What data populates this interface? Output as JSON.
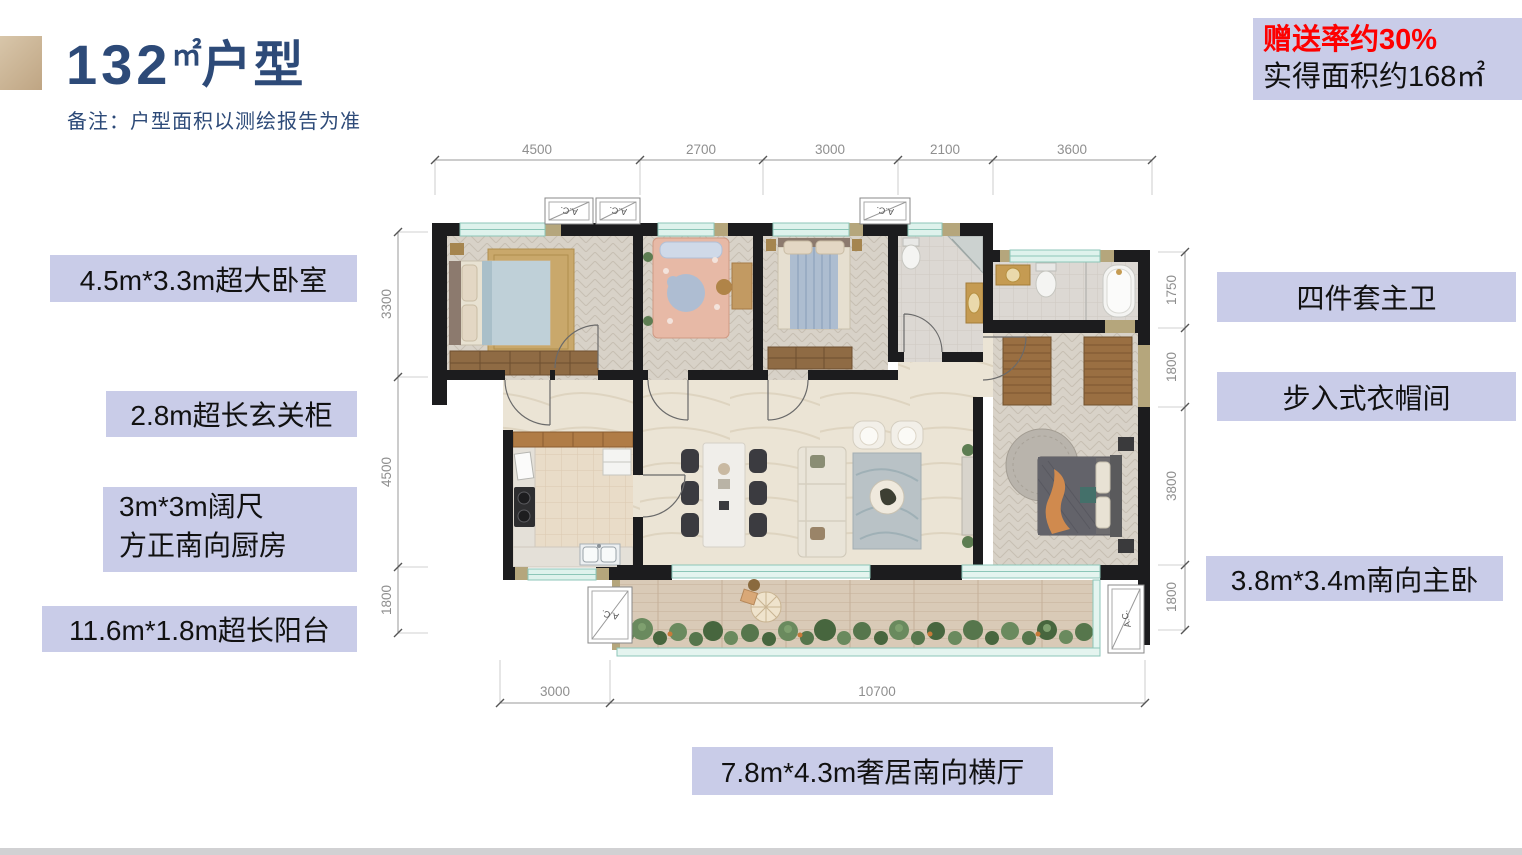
{
  "header": {
    "area_number": "132",
    "area_unit": "㎡",
    "title_suffix": "户型",
    "note": "备注：户型面积以测绘报告为准"
  },
  "promo": {
    "bonus_rate": "赠送率约30%",
    "actual_area": "实得面积约168㎡"
  },
  "labels": {
    "bedroom": "4.5m*3.3m超大卧室",
    "foyer_cabinet": "2.8m超长玄关柜",
    "kitchen_line1": "3m*3m阔尺",
    "kitchen_line2": "方正南向厨房",
    "balcony": "11.6m*1.8m超长阳台",
    "master_bath": "四件套主卫",
    "cloakroom": "步入式衣帽间",
    "master_bedroom": "3.8m*3.4m南向主卧",
    "living_hall": "7.8m*4.3m奢居南向横厅"
  },
  "plan": {
    "dims_top": [
      "4500",
      "2700",
      "3000",
      "2100",
      "3600"
    ],
    "dims_left": [
      "3300",
      "4500",
      "1800"
    ],
    "dims_right": [
      "1750",
      "1800",
      "3800",
      "1800"
    ],
    "dims_bottom": [
      "3000",
      "10700"
    ],
    "ac_label": "A.C."
  },
  "colors": {
    "accent_red": "#fe0000",
    "label_bg": "#c9cce8",
    "title_navy": "#2d4a78",
    "wall_black": "#1c1c1e"
  }
}
